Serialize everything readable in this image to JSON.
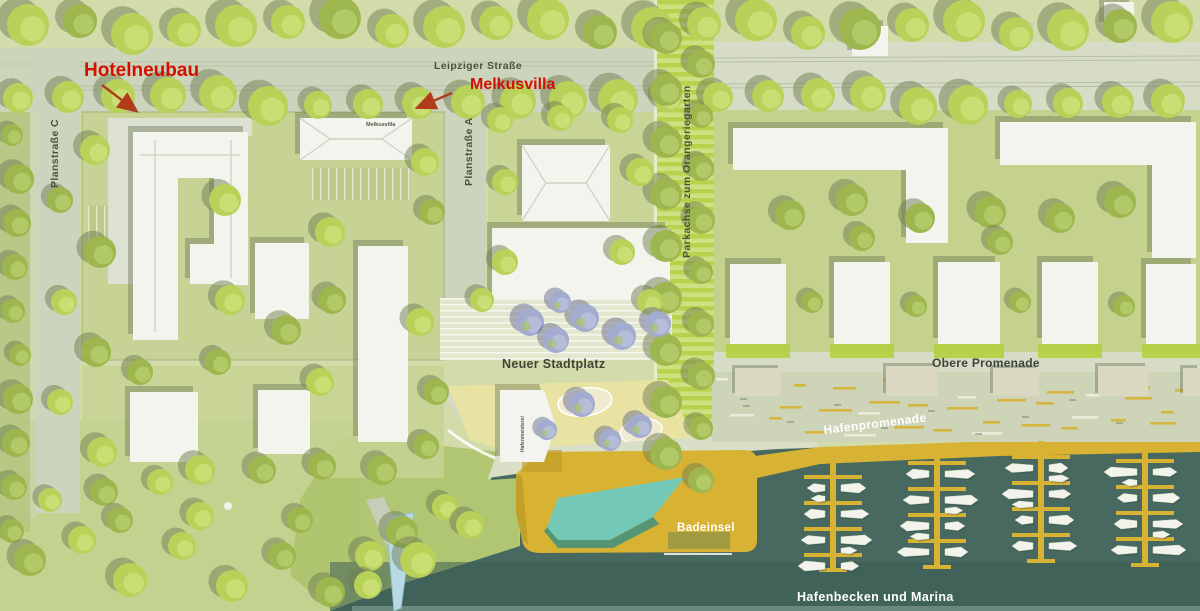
{
  "annotations": {
    "hotelneubau": {
      "label": "Hotelneubau"
    },
    "melkusvilla": {
      "label": "Melkusvilla"
    }
  },
  "streets": {
    "leipziger": "Leipziger Straße",
    "planstrasse_c": "Planstraße C",
    "planstrasse_a": "Planstraße A",
    "parkachse": "Parkachse zum Orangeriegarten",
    "obere_promenade": "Obere Promenade",
    "hafenpromenade": "Hafenpromenade"
  },
  "places": {
    "stadtplatz": "Neuer Stadtplatz",
    "badeinsel": "Badeinsel",
    "hafenbecken": "Hafenbecken und Marina",
    "melkusvilla_roof": "Melkusvilla",
    "hafenmeisterei": "Hafenmeisterei"
  },
  "marina": {
    "piers": [
      {
        "x": 833,
        "top": 461
      },
      {
        "x": 937,
        "top": 447
      },
      {
        "x": 1041,
        "top": 441
      },
      {
        "x": 1145,
        "top": 445
      }
    ],
    "pier_bottom": 572,
    "finger_half_len": 29
  },
  "colors": {
    "base": "#d3dbab",
    "street": "#cdd4bd",
    "street_light": "#d7dcc7",
    "plot": "#c6d393",
    "plot_dark": "#b9cc7a",
    "hedge": "#94a45a",
    "axis1": "#b7d24c",
    "axis2": "#cfe083",
    "garden": "#b4d045",
    "building": "#f4f4ee",
    "building_low": "#dde1d2",
    "roofline": "#cdd0c0",
    "shadow": "#6e7b5a",
    "tree": "#b8d159",
    "tree_light": "#cfe17c",
    "tree_shadow": "#6f7d54",
    "tree_olive": "#9db64e",
    "tree_blue": "#a3abce",
    "tree_blue_light": "#bcc3de",
    "tree_blue_shadow": "#676e8e",
    "water": "#47695f",
    "water_deep": "#3d5d54",
    "water_edge": "#7e988b",
    "quay": "#d8b233",
    "quay_dark": "#bf9d28",
    "pool": "#74c9b6",
    "pool_dark": "#3f8f80",
    "deck_olive": "#a09a42",
    "plaza": "#e4e7cf",
    "plaza_stripe": "#f4f5e8",
    "plaza_yellow": "#e9e3a3",
    "patch": "#f0ead0",
    "ramp_blue": "#b7dae5",
    "terrace": "#cdd4b8",
    "pavilion": "#dbd8c1",
    "label_red": "#d40f00",
    "arrow": "#b13c1c",
    "boat": "#f2f3ea",
    "boat_shadow": "#2f4a41"
  }
}
